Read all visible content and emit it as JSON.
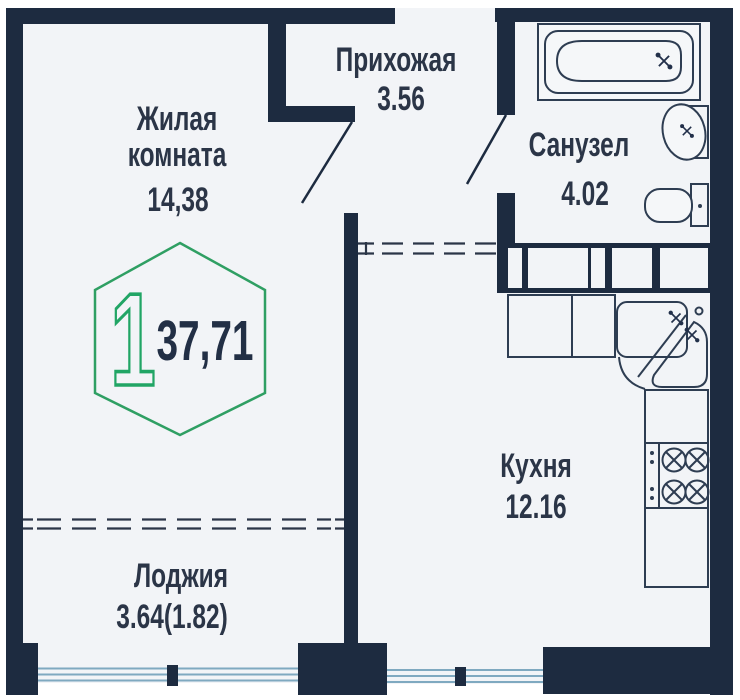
{
  "plan": {
    "title": "1-room apartment floor plan",
    "badge": {
      "room_count": "1",
      "total_area": "37,71"
    },
    "rooms": {
      "living": {
        "line1": "Жилая",
        "line2": "комната",
        "area": "14,38"
      },
      "hallway": {
        "name": "Прихожая",
        "area": "3.56"
      },
      "bathroom": {
        "name": "Санузел",
        "area": "4.02"
      },
      "kitchen": {
        "name": "Кухня",
        "area": "12.16"
      },
      "loggia": {
        "name": "Лоджия",
        "area": "3.64(1.82)"
      }
    },
    "icons": [
      "bathtub-icon",
      "bath-sink-icon",
      "toilet-icon",
      "kitchen-corner-sink-icon",
      "stove-icon",
      "door-swing-icon",
      "window-icon",
      "vent-shaft-icon",
      "hexagon-badge-icon"
    ],
    "colors": {
      "wall": "#1d2b40",
      "room_fill": "#f2f4f7",
      "hexagon_green": "#2f9f63",
      "digit_green": "#21a565",
      "window_blue": "#7fa9c0",
      "text": "#2b3547"
    }
  }
}
